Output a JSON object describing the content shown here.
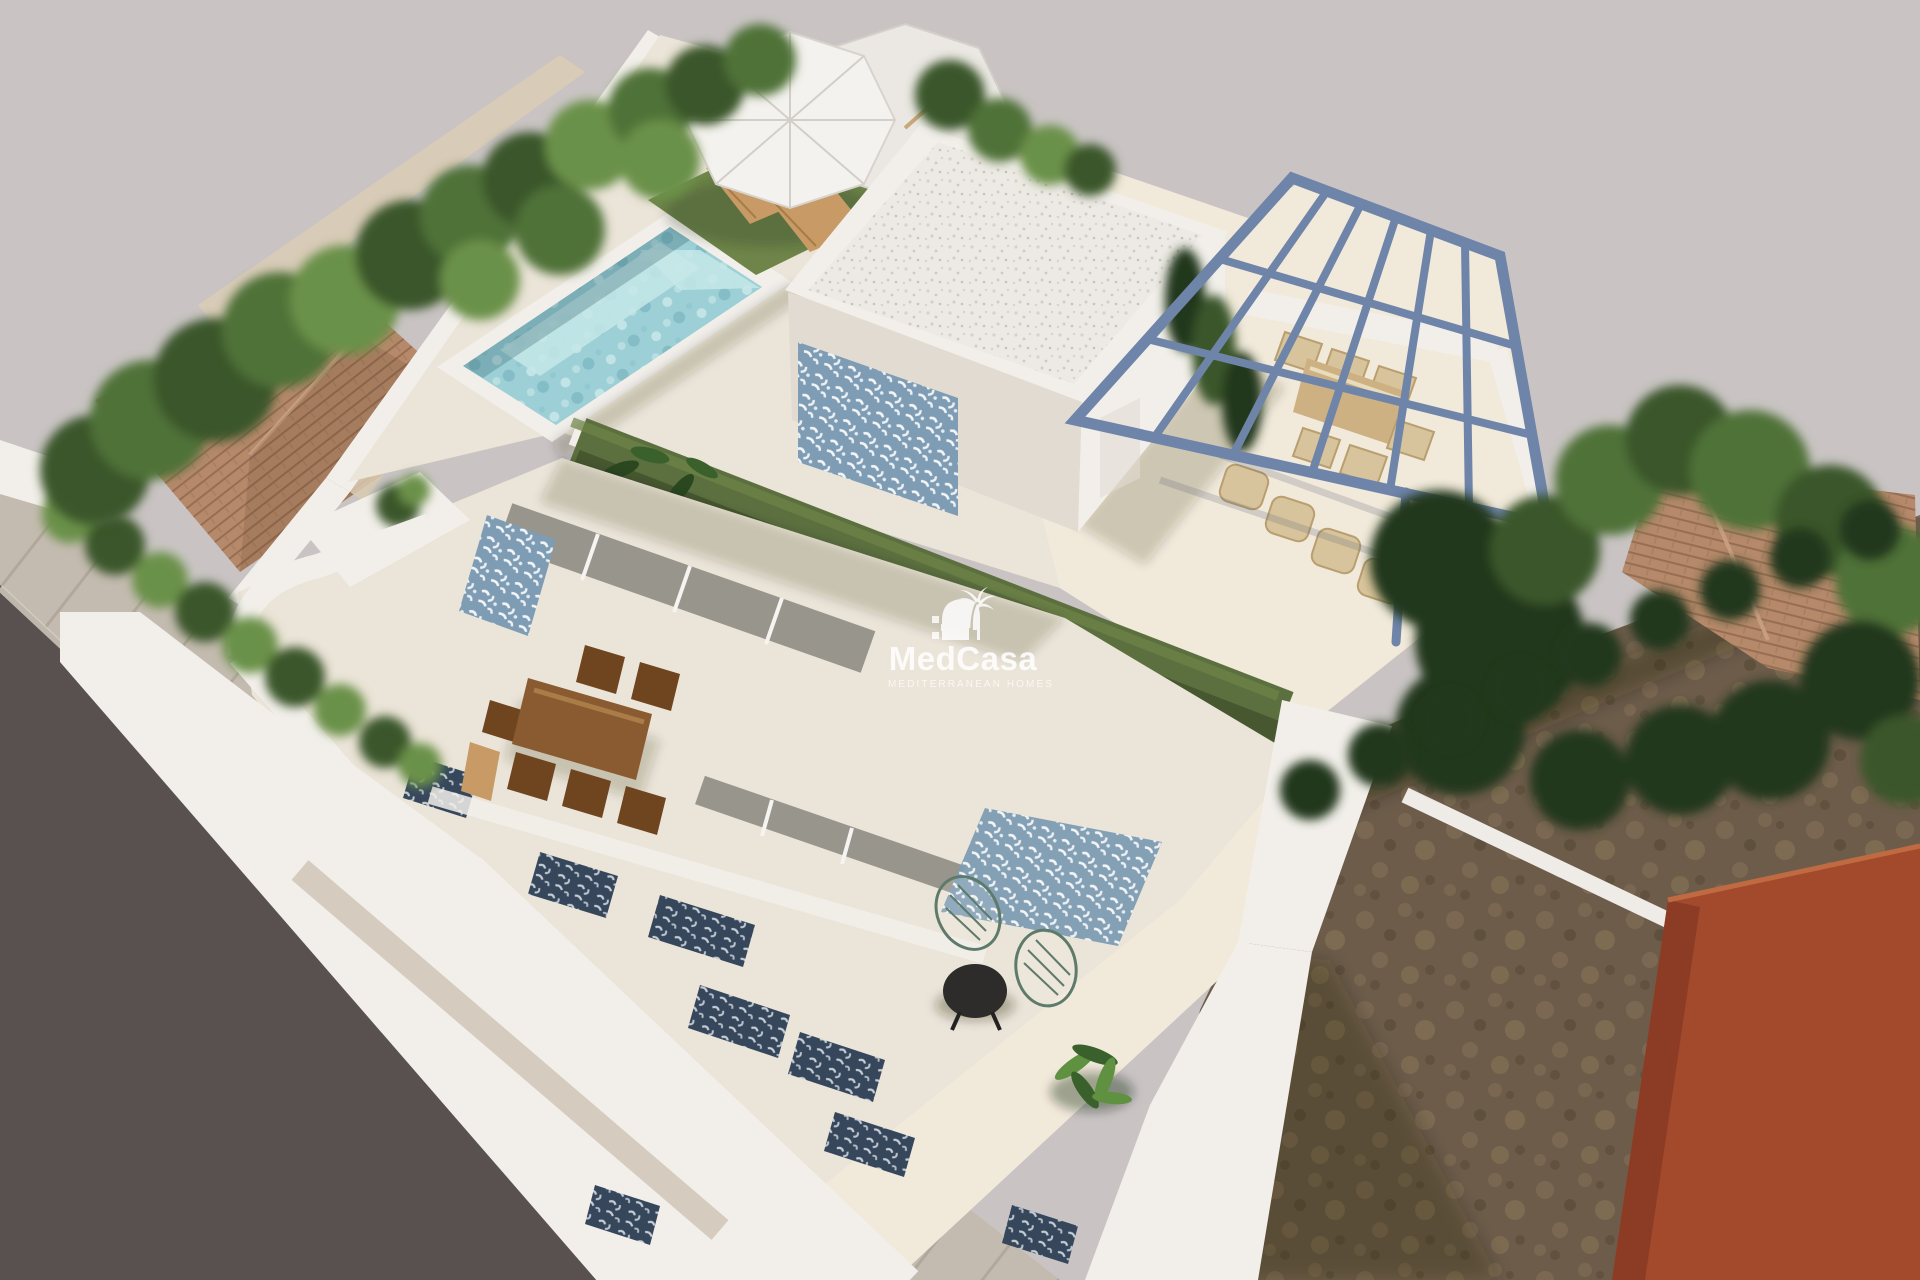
{
  "watermark": {
    "brand": "MedCasa",
    "tagline": "MEDITERRANEAN HOMES",
    "icon": "palm-house-logo",
    "color": "#ffffff"
  },
  "palette": {
    "bg": "#c9c4c3",
    "road": "#595150",
    "sidewalk": "#c4bbb0",
    "dirt": "#6d5c4a",
    "orange": "#a34a2c",
    "orange_dark": "#8c3c24",
    "terracotta": "#b5896a",
    "wall_white": "#f2efea",
    "floor_cream": "#ebe4d8",
    "wall_shade": "#e1dbd2",
    "pool_water": "#9ccfd6",
    "tile_blue": "#7e9cb3",
    "tile_navy": "#36475c",
    "pergola": "#6e84a8",
    "grass": "#5b6f3f",
    "grass_light": "#6e8449",
    "tree1": "#4f7238",
    "tree2": "#3a572a",
    "tree3": "#6a9148",
    "tree4": "#24391d",
    "wood": "#8a5a30",
    "wood_light": "#c79a66",
    "wicker": "#d8c49c",
    "watermark": "#ffffff"
  }
}
